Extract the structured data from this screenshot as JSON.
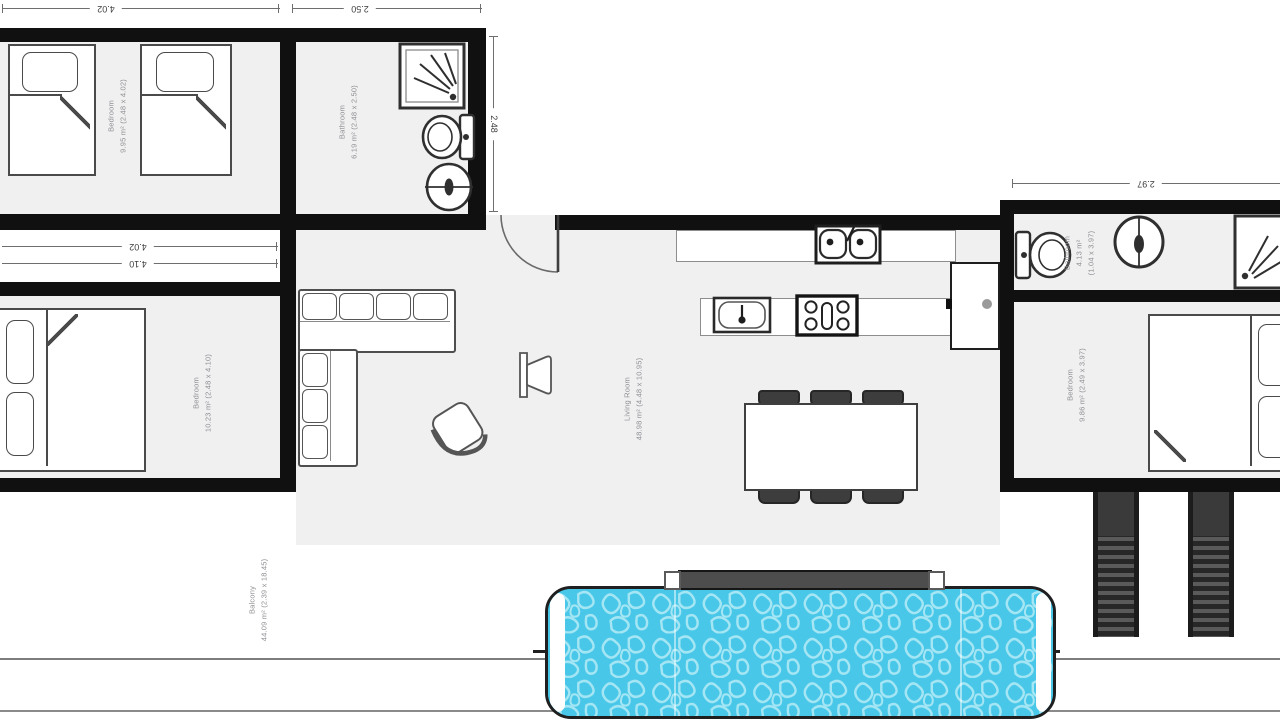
{
  "plan_type": "floor-plan",
  "rooms": [
    {
      "name": "Bedroom",
      "area": "9.95 m²",
      "dims": "(2.48 x 4.02)"
    },
    {
      "name": "Bathroom",
      "area": "6.19 m²",
      "dims": "(2.48 x 2.50)"
    },
    {
      "name": "Bedroom",
      "area": "10.23 m²",
      "dims": "(2.48 x 4.10)"
    },
    {
      "name": "Living Room",
      "area": "48.98 m²",
      "dims": "(4.48 x 10.95)"
    },
    {
      "name": "Bathroom",
      "area": "4.13 m²",
      "dims": "(1.04 x 3.97)"
    },
    {
      "name": "Bedroom",
      "area": "9.86 m²",
      "dims": "(2.49 x 3.97)"
    },
    {
      "name": "Balcony",
      "area": "44.09 m²",
      "dims": "(2.39 x 18.45)"
    }
  ],
  "dimensions": {
    "top_left_width": "4.02",
    "top_bath_width": "2.50",
    "left_room_upper_width": "4.02",
    "left_room_lower_width": "4.10",
    "bath_height": "2.48",
    "right_wing_width": "2.97"
  },
  "colors": {
    "wall": "#101010",
    "floor": "#f0f0f1",
    "pool_water": "#49c7e8",
    "pool_texture": "#a5e6f4",
    "furniture_outline": "#4a4a4a",
    "room_label": "#8f9094"
  }
}
